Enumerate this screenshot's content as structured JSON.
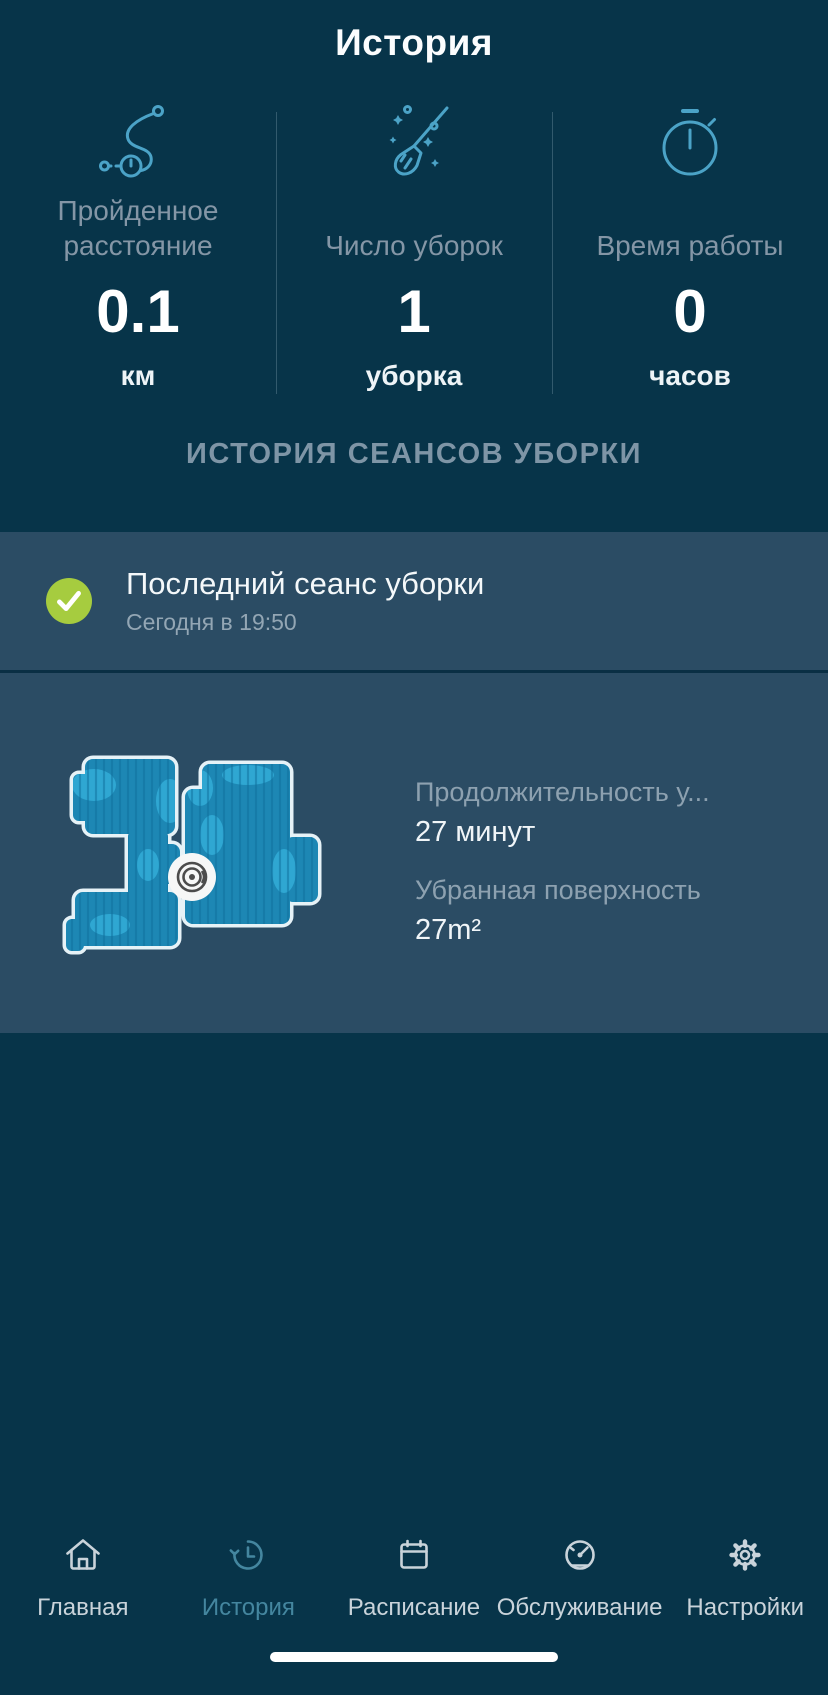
{
  "header": {
    "title": "История"
  },
  "stats": [
    {
      "icon": "route-icon",
      "label": "Пройденное расстояние",
      "value": "0.1",
      "unit": "км"
    },
    {
      "icon": "broom-icon",
      "label": "Число уборок",
      "value": "1",
      "unit": "уборка"
    },
    {
      "icon": "stopwatch-icon",
      "label": "Время работы",
      "value": "0",
      "unit": "часов"
    }
  ],
  "section": {
    "title": "ИСТОРИЯ СЕАНСОВ УБОРКИ"
  },
  "last_session": {
    "status_icon": "check-icon",
    "title": "Последний сеанс уборки",
    "subtitle": "Сегодня в 19:50"
  },
  "session_detail": {
    "map_icon": "robot-marker-icon",
    "duration_label": "Продолжительность у...",
    "duration_value": "27 минут",
    "area_label": "Убранная поверхность",
    "area_value": "27m²"
  },
  "tab_bar": {
    "items": [
      {
        "icon": "home-icon",
        "label": "Главная",
        "active": false
      },
      {
        "icon": "history-icon",
        "label": "История",
        "active": true
      },
      {
        "icon": "calendar-icon",
        "label": "Расписание",
        "active": false
      },
      {
        "icon": "gauge-icon",
        "label": "Обслуживание",
        "active": false
      },
      {
        "icon": "gear-icon",
        "label": "Настройки",
        "active": false
      }
    ]
  },
  "colors": {
    "background": "#073449",
    "card": "#2b4c64",
    "accent_icon": "#4ba3c7",
    "label": "#8496a6",
    "success": "#a6cc3f",
    "tab_active": "#44869f",
    "tab_inactive": "#c9d3da",
    "map_fill": "#1d87b4",
    "map_light": "#2fa7d2"
  }
}
